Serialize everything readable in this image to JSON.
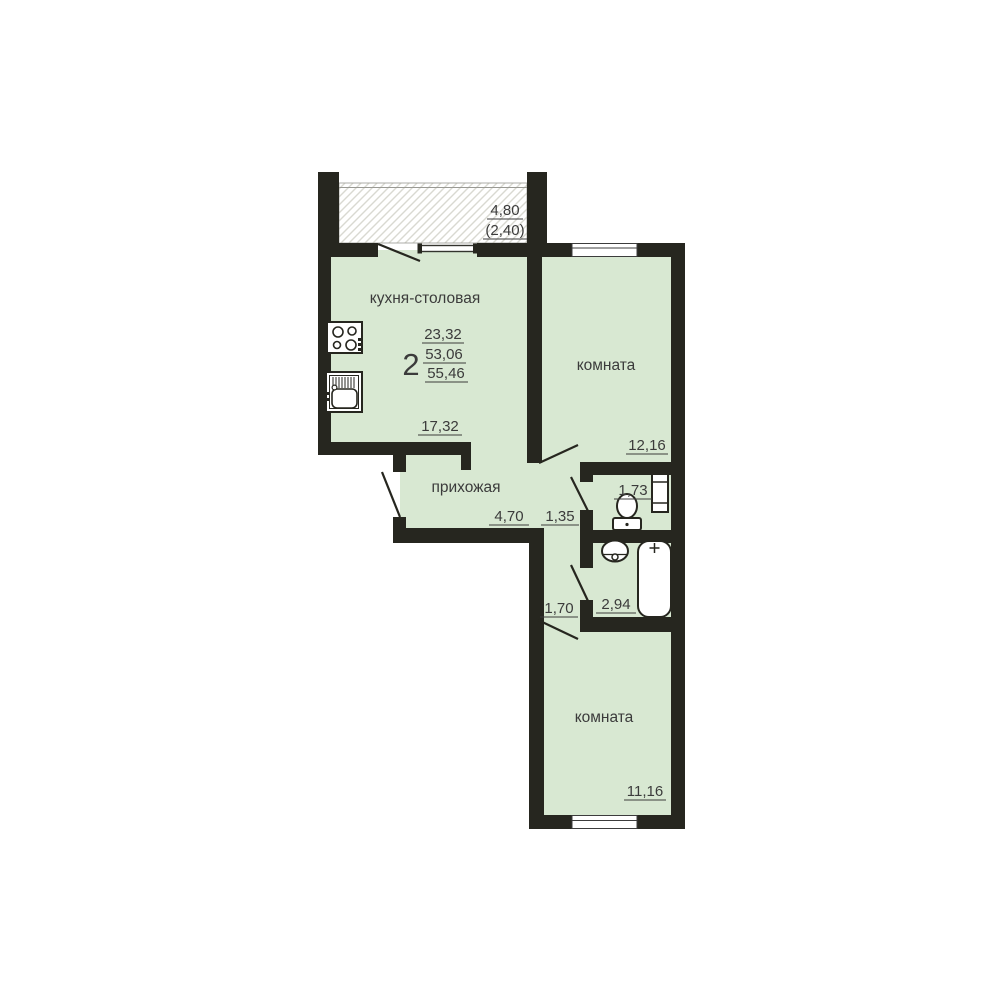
{
  "plan": {
    "summary": {
      "rooms_count": "2",
      "living_area": "23,32",
      "apartment_area": "53,06",
      "total_area": "55,46"
    },
    "kitchen": {
      "name": "кухня-столовая",
      "area": "17,32"
    },
    "balcony": {
      "length": "4,80",
      "reduced_area": "(2,40)"
    },
    "room_top": {
      "name": "комната",
      "area": "12,16"
    },
    "hallway": {
      "name": "прихожая",
      "area": "4,70"
    },
    "corridor_upper": {
      "width": "1,35"
    },
    "wc": {
      "area": "1,73"
    },
    "bathroom": {
      "area": "2,94"
    },
    "corridor_lower": {
      "width": "1,70"
    },
    "room_bottom": {
      "name": "комната",
      "area": "11,16"
    },
    "colors": {
      "wall": "#26261f",
      "room_fill": "#d8e8d2",
      "hatch_line": "#d9d9d1",
      "text": "#3b3b3b",
      "background": "#ffffff"
    }
  }
}
